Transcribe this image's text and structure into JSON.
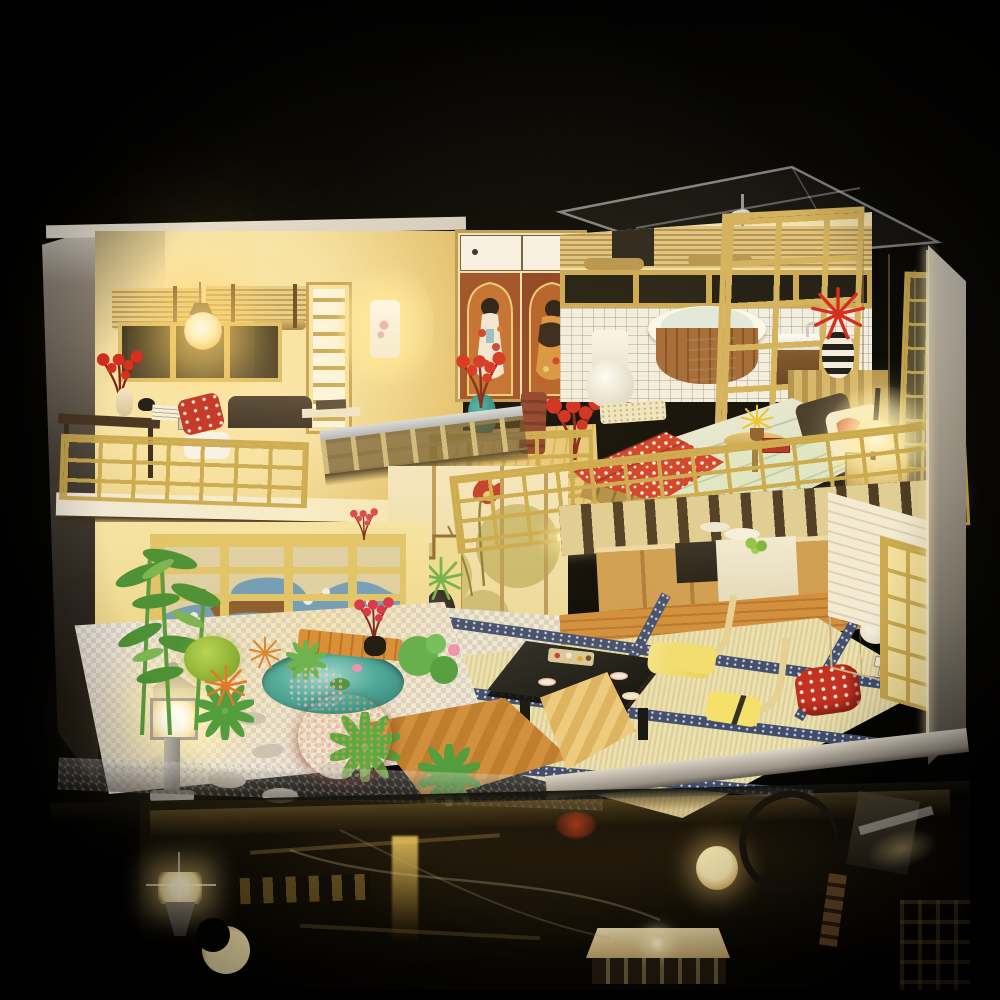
{
  "meta": {
    "title": "DIY miniature dollhouse night photo",
    "kind": "product-photo"
  },
  "scene": {
    "description": "Two-story Japanese-style DIY miniature dollhouse glowing with warm LED lights, standing on a glossy black reflective surface against a pure black background. Upper left: living room with bamboo blinds, pendant bulb, wall sconce, geisha-print wardrobe, desk and chairs behind a golden lattice loft railing. Upper right under a clear acrylic roof: bathroom with toilet, round wooden bathtub, sink and shower, and a bedroom with a red-and-white floral bed, glowing table lamp and folding lattice screens. Lower level: zen garden with bamboo, succulents, red bushes, pond, wooden deck and a glowing stone lantern; lotus-painted shoji wall and staircase; tatami dining area with a black low table full of miniature food, floor chairs, red pillow, sideboard; wooden kitchen with white counter. The lights reflect in the black tabletop below.",
    "rooms": [
      "living room",
      "bedroom",
      "bathroom",
      "kitchen",
      "tatami dining area",
      "zen garden"
    ],
    "objects": [
      "bamboo blinds",
      "pendant bulb",
      "wall sconce",
      "geisha wardrobe",
      "writing desk",
      "red pillow chair",
      "loft railing",
      "lotus shoji wall",
      "staircase",
      "shoe shelf",
      "stone lantern",
      "bamboo plant",
      "succulents",
      "red bush",
      "pond",
      "wood deck",
      "stepping stones",
      "tatami mats",
      "black low table",
      "sushi platters",
      "floor chairs",
      "red floral pillow",
      "sideboard",
      "books",
      "kitchen cabinets",
      "stove",
      "counter with fruit",
      "bathtub",
      "towel",
      "toilet",
      "sink",
      "shower head",
      "lattice partition",
      "bed",
      "green knit blanket",
      "red floral throw",
      "table lamp",
      "nightstand",
      "striped vase with red lily",
      "teal vase with red flowers",
      "round side table",
      "folding screens",
      "glass roof",
      "reflections of lantern, bulbs and railings"
    ]
  },
  "palette": {
    "bg": "#000000",
    "wallCream": "#f3e7c2",
    "glowCore": "#fff7dc",
    "glowWarm": "#ffe9a8",
    "goldLattice": "#c9a84c",
    "woodLight": "#e4cd8a",
    "wood": "#c89850",
    "woodDark": "#8a6230",
    "floorWood": "#c9812f",
    "tatami": "#ece1b2",
    "tatamiBorder": "#3d4a6c",
    "red": "#c92b1d",
    "teal": "#1f8f8f",
    "leafGreen": "#55a03a",
    "stoneGray": "#b5afa6",
    "tileWhite": "#f2efe6",
    "lacquerBlack": "#15120e"
  }
}
